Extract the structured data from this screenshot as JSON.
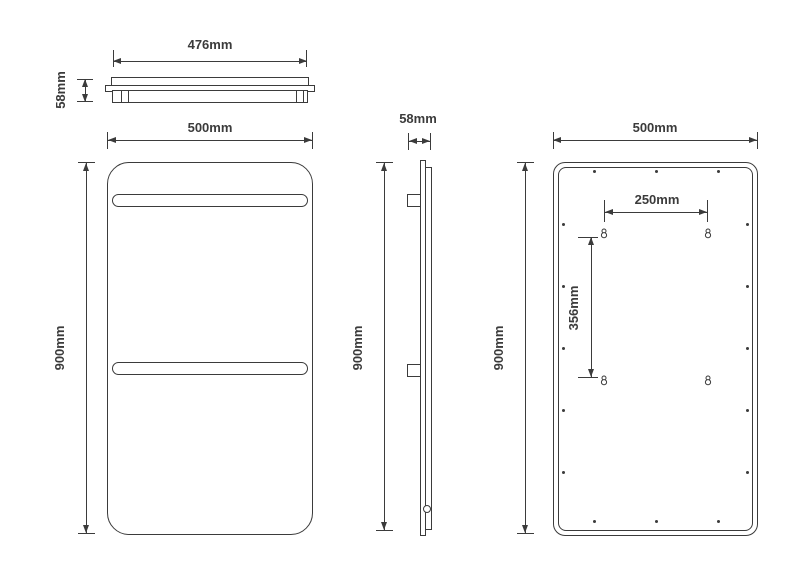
{
  "views": {
    "top": {
      "width": "476mm",
      "depth": "58mm"
    },
    "front": {
      "width": "500mm",
      "height": "900mm"
    },
    "side": {
      "depth": "58mm",
      "height": "900mm"
    },
    "back": {
      "width": "500mm",
      "height": "900mm",
      "mounting_hole_horizontal_spacing": "250mm",
      "mounting_hole_vertical_spacing": "356mm"
    }
  },
  "colors": {
    "line": "#3b3b3b",
    "background": "#ffffff"
  }
}
